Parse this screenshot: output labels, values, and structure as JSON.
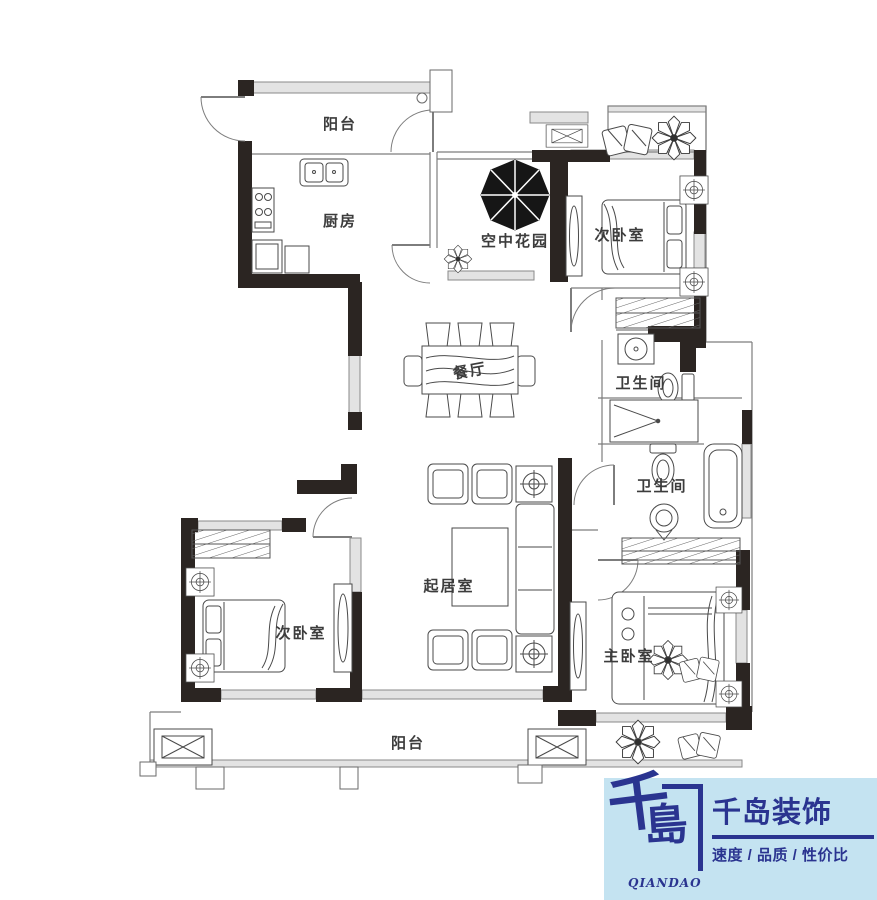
{
  "plan": {
    "rooms": {
      "balcony_top": {
        "label": "阳台"
      },
      "kitchen": {
        "label": "厨房"
      },
      "sky_garden": {
        "label": "空中花园"
      },
      "bedroom2_top": {
        "label": "次卧室"
      },
      "bath_upper": {
        "label": "卫生间"
      },
      "dining": {
        "label": "餐厅"
      },
      "bath_lower": {
        "label": "卫生间"
      },
      "living": {
        "label": "起居室"
      },
      "bedroom2_bottom": {
        "label": "次卧室"
      },
      "master_bedroom": {
        "label": "主卧室"
      },
      "balcony_bottom": {
        "label": "阳台"
      }
    },
    "colors": {
      "wall": "#2b2522",
      "line": "#5a5a5a"
    }
  },
  "logo": {
    "mark_top": "千",
    "mark_bottom": "島",
    "roman": "QIANDAO",
    "company": "千岛装饰",
    "tagline": "速度 / 品质 / 性价比",
    "colors": {
      "navy": "#2a3490",
      "light_blue": "#c4e3f1"
    }
  }
}
